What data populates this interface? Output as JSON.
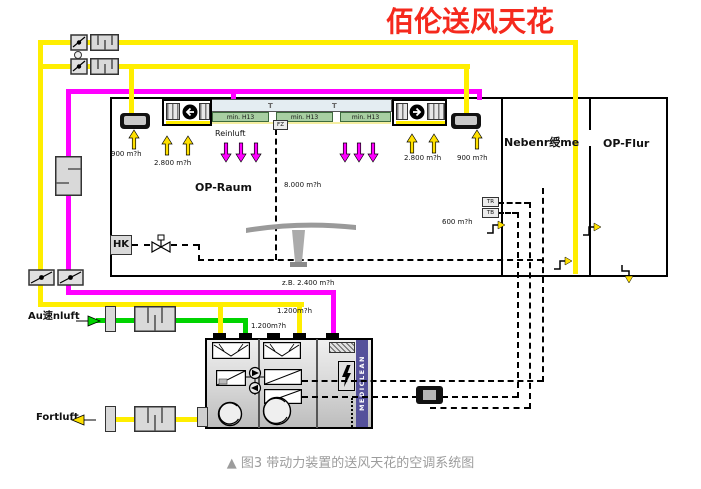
{
  "title": "佰伦送风天花",
  "caption": "▲ 图3 带动力装置的送风天花的空调系统图",
  "rooms": {
    "op_raum": "OP-Raum",
    "nebenraeume": "Nebenr绶me",
    "op_flur": "OP-Flur"
  },
  "labels": {
    "reinluft": "Reinluft",
    "hk": "HK",
    "aussenluft": "Au速nluft",
    "fortluft": "Fortluft",
    "mediclean": "MEDICLEAN",
    "filter_h13": "min. H13",
    "t": "T",
    "fz": "FZ",
    "tr": "TR",
    "tb": "TB"
  },
  "flows": {
    "outlet": "900 m?h",
    "fan_unit": "2.800 m?h",
    "room_total": "8.000 m?h",
    "nebenraum": "600 m?h",
    "recirc": "z.B. 2.400 m?h",
    "branch": "1.200m?h"
  },
  "colors": {
    "supply_yellow": "#ffee00",
    "recirc_magenta": "#ff00ff",
    "fresh_green": "#00d400",
    "strip_purple": "#55519b",
    "filter_green": "#a8cfa2",
    "title_red": "#f5291d"
  }
}
